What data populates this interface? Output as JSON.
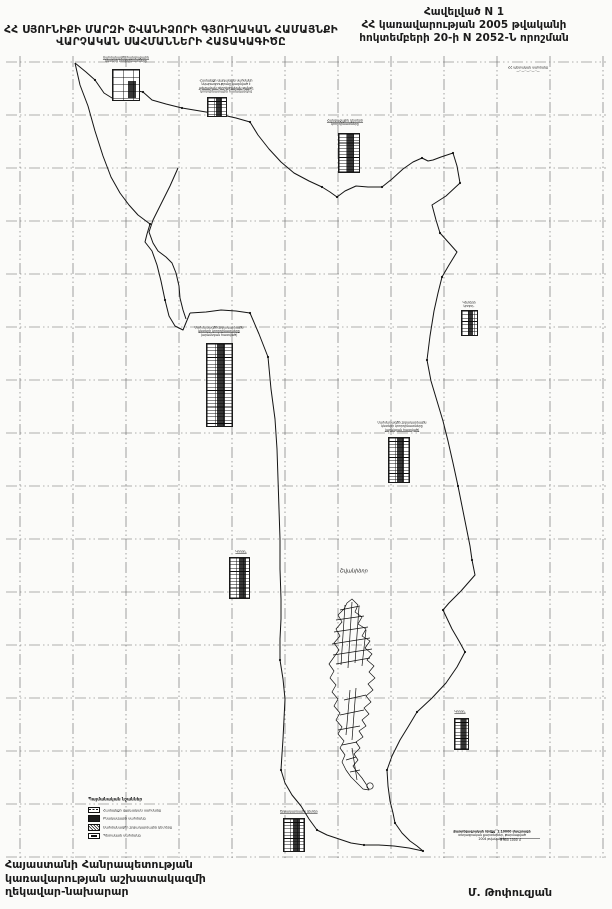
{
  "page_title": "ՀՀ Սյունիքի մարզի Շվանիձորի համայնքի վարչական սահմանների հատակագիծ",
  "header": {
    "appendix": "Հավելված  N 1",
    "decree_line1": "ՀՀ կառավարության 2005 թվականի",
    "decree_line2": "հոկտեմբերի 20-ի N 2052-Ն որոշման"
  },
  "title": {
    "line1": "ՀՀ ՍՅՈՒՆԻՔԻ ՄԱՐԶԻ ՇՎԱՆԻՁՈՐԻ ԳՅՈՒՂԱԿԱՆ ՀԱՄԱՅՆՔԻ",
    "line2": "ՎԱՐՉԱԿԱՆ  ՍԱՀՄԱՆՆԵՐԻ  ՀԱՏԱԿԱԳԻԾԸ"
  },
  "map": {
    "village_label": "Շվանիձոր",
    "blocks": {
      "b1": {
        "lines": [
          "Սահմանագծի հանգուցային",
          "կետերի կոորդինատները"
        ]
      },
      "b2": {
        "lines": [
          "Համայնքի վարչական սահմանի",
          "նկարագրությունը կազմված է",
          "պետական գեոդեզիական ցանցի",
          "կոորդինատային համակարգով"
        ]
      },
      "b3": {
        "lines": [
          "Հանգուցային կետերի",
          "կոորդինատները"
        ]
      },
      "b4": {
        "lines": [
          "ՀՀ պետական սահմանը",
          "—··—··—··—··—"
        ]
      },
      "b5": {
        "lines": [
          "Սահմանագծի շրջադարձային",
          "կետերի կոորդինատները",
          "(արևմտյան հատված)"
        ]
      },
      "b6": {
        "lines": [
          "Սահմանագծի շրջադարձային",
          "կետերի կոորդինատները",
          "(արևելյան հատված)"
        ]
      },
      "b7": {
        "lines": [
          "Կետերի",
          "կոորդ."
        ]
      },
      "b9": {
        "lines": [
          "Կոորդ."
        ]
      },
      "b10": {
        "lines": [
          "Կոորդ."
        ]
      },
      "b12": {
        "lines": [
          "Շրջադարձային կետեր"
        ]
      },
      "b13": {
        "lines": [
          "Քարտեզագրական հիմքը՝ 1:10000 մասշտաբի",
          "տեղագրական քարտեզներ, թարմացված",
          "2004 թվականին"
        ],
        "scale": "0   500   1000 մ"
      }
    }
  },
  "legend": {
    "title": "Պայմանական նշաններ",
    "items": [
      "Համայնքի վարչական սահմանը",
      "Բնակավայրի սահմանը",
      "Սահմանագծի շրջադարձային կետերը",
      "Պետական սահմանը"
    ]
  },
  "footer": {
    "left_line1": "Հայաստանի Հանրապետության",
    "left_line2": "կառավարության աշխատակազմի",
    "left_line3": "ղեկավար-նախարար",
    "signature": "Մ. Թոփուզյան"
  }
}
